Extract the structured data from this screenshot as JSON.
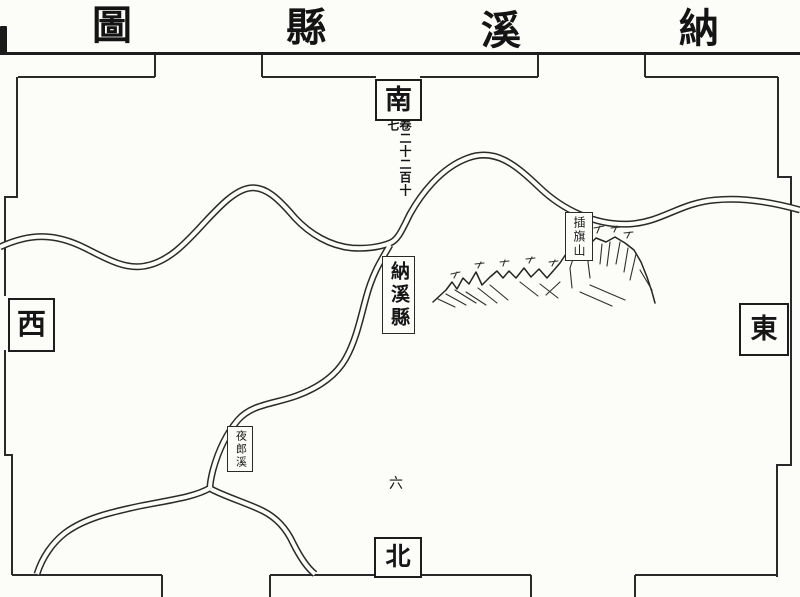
{
  "title": {
    "text_rtl": "納溪縣圖",
    "display_order_left_to_right": [
      "圖",
      "縣",
      "溪",
      "納"
    ]
  },
  "compass": {
    "south": "南",
    "north": "北",
    "west": "西",
    "east": "東"
  },
  "volume_note": {
    "text": "卷二十二百十七"
  },
  "labels": {
    "county": "納溪縣",
    "mountain": "插旗山",
    "creek": "夜郎溪",
    "folio": "六"
  },
  "colors": {
    "ink": "#1d1d1d",
    "paper": "#fcfcf8"
  }
}
